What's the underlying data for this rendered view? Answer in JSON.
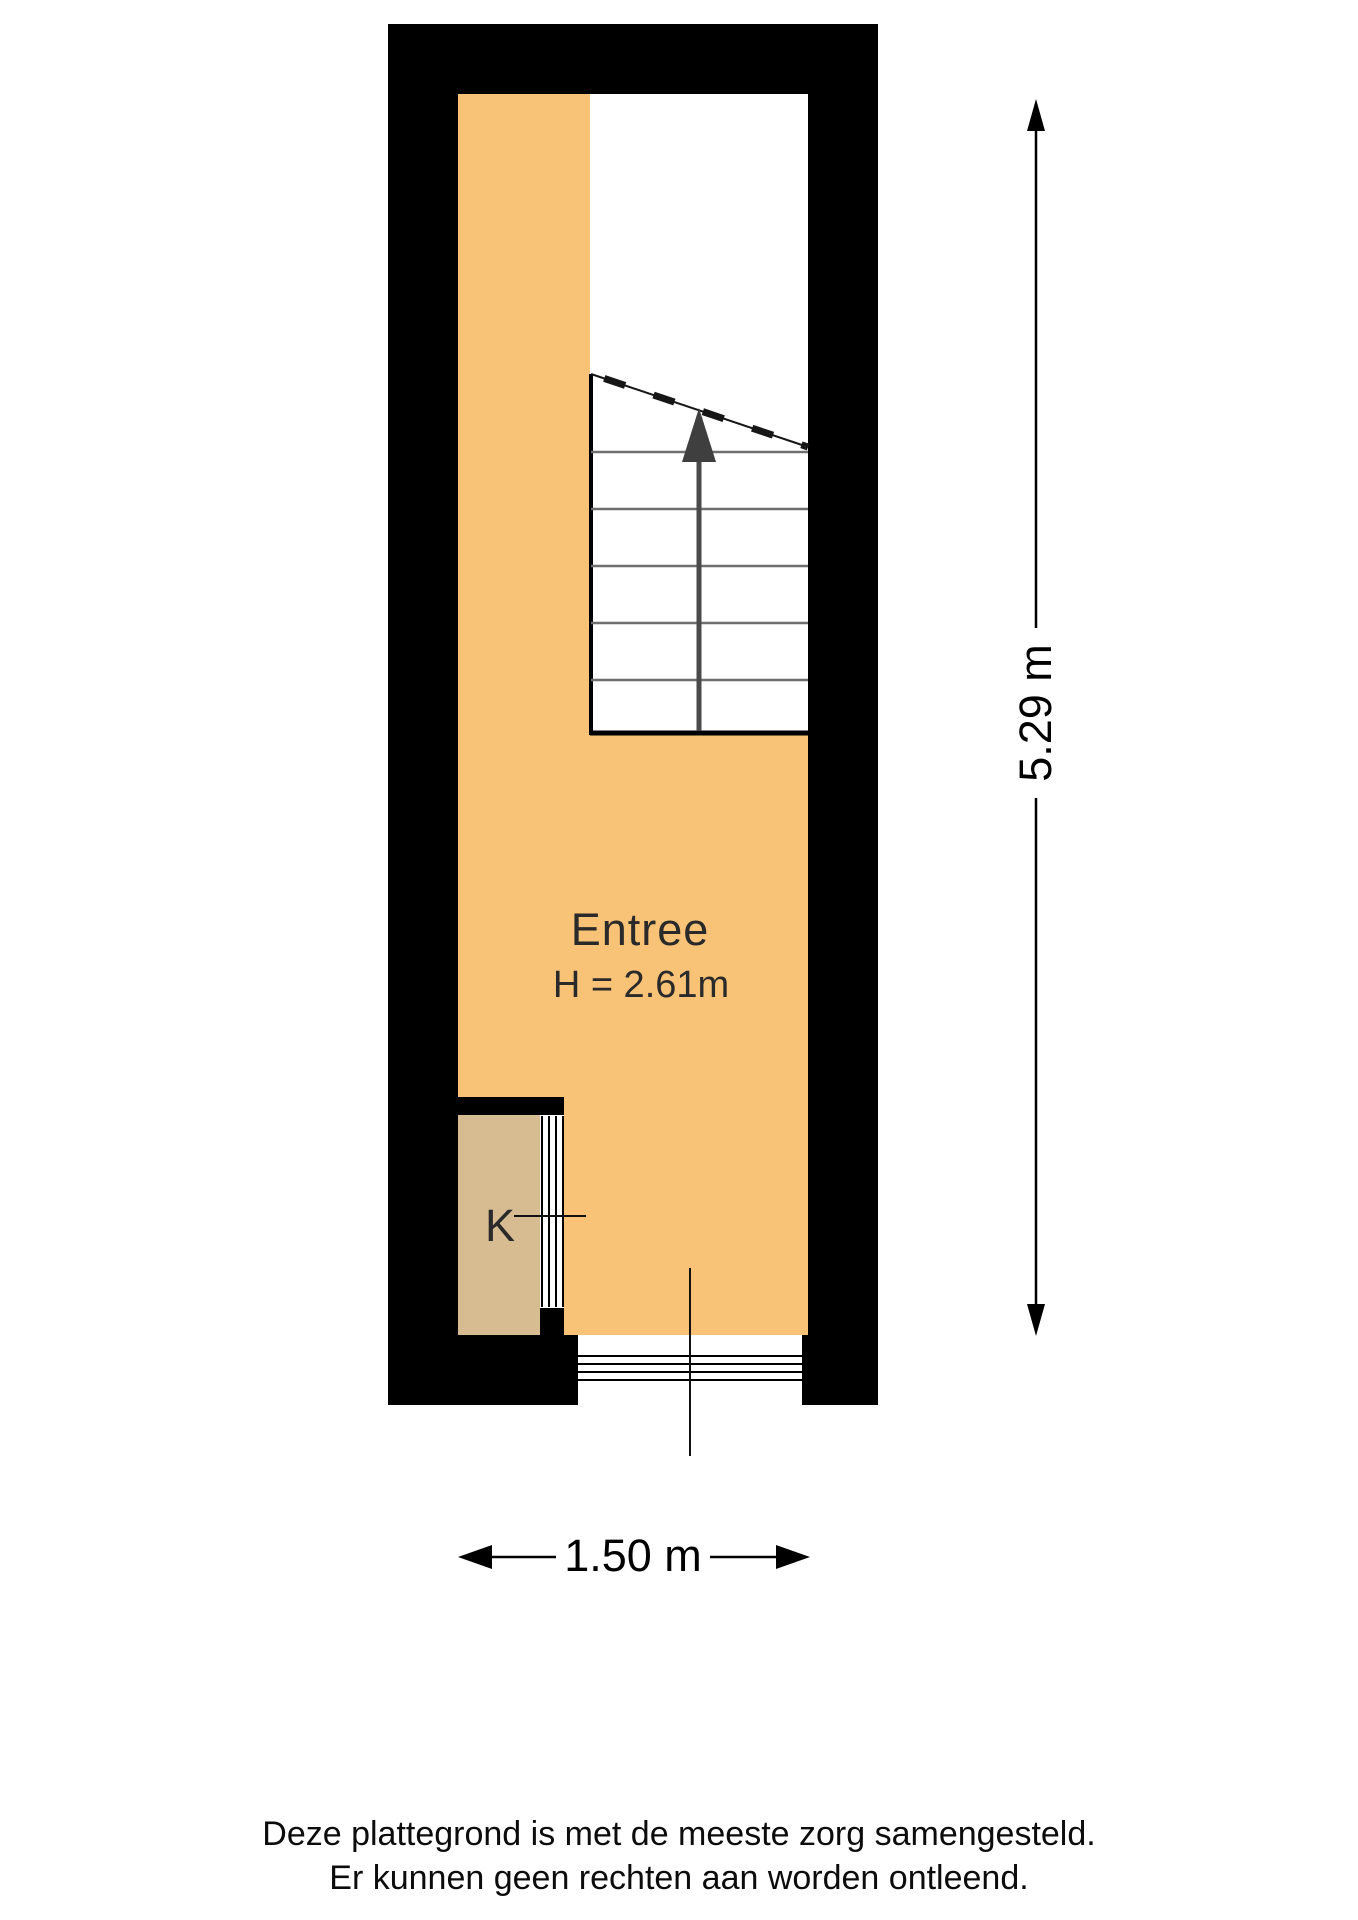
{
  "colors": {
    "background": "#ffffff",
    "wall": "#000000",
    "floor": "#f8c377",
    "closet": "#d7bc92",
    "stair_line": "#6f6f6f",
    "stair_arrow": "#3f3f3f",
    "ink": "#111111",
    "text": "#2a2a2a"
  },
  "plan": {
    "room": {
      "name": "Entree",
      "ceiling_height": "H = 2.61m"
    },
    "closet": {
      "label": "K"
    },
    "stairs": {
      "arrow_direction": "up"
    }
  },
  "dimensions": {
    "width_label": "1.50 m",
    "height_label": "5.29 m"
  },
  "footer": {
    "line1": "Deze plattegrond is met de meeste zorg samengesteld.",
    "line2": "Er kunnen geen rechten aan worden ontleend."
  }
}
